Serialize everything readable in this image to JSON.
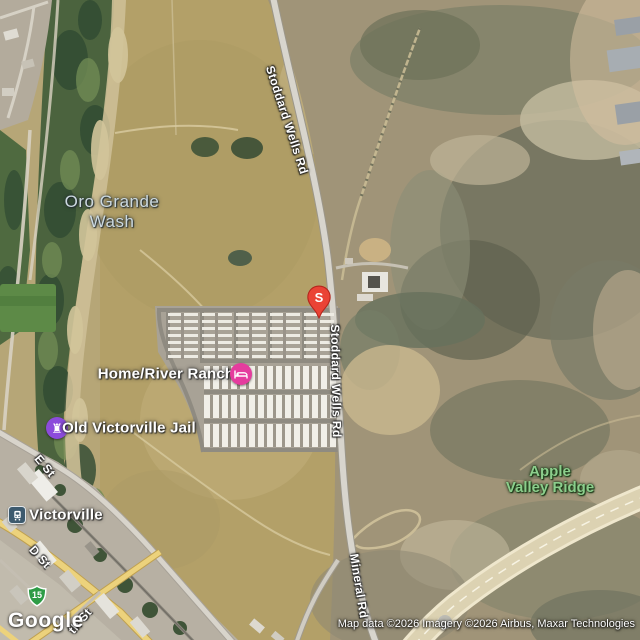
{
  "map": {
    "view_type": "satellite",
    "marker": {
      "label": "S",
      "color": "#EA4335"
    },
    "labels": {
      "oro_grande_wash": {
        "line1": "Oro Grande",
        "line2": "Wash"
      },
      "stoddard_wells_rd": "Stoddard Wells Rd",
      "home_river_ranch": "Home/River Ranch",
      "old_victorville_jail": "Old Victorville Jail",
      "victorville_station": "Victorville",
      "apple_valley_ridge": {
        "line1": "Apple",
        "line2": "Valley Ridge"
      },
      "e_st": "E St",
      "d_st": "D St",
      "nth_st": "th St",
      "mineral_rd": "Mineral Rd",
      "route_15": "15"
    },
    "icons": {
      "lodging": "bed-icon",
      "landmark": "castle-rook-icon",
      "transit": "train-icon",
      "landmark_glyph": "♜"
    },
    "colors": {
      "marker_red": "#EA4335",
      "lodging_pink": "#E53C9E",
      "landmark_purple": "#8C4BDB",
      "transit_slate": "#3D5A6E",
      "shield_green": "#2E9C46",
      "park_label_green": "#8CCE8C"
    },
    "footer": {
      "logo": "Google",
      "attribution": "Map data ©2026 Imagery ©2026 Airbus, Maxar Technologies"
    }
  }
}
